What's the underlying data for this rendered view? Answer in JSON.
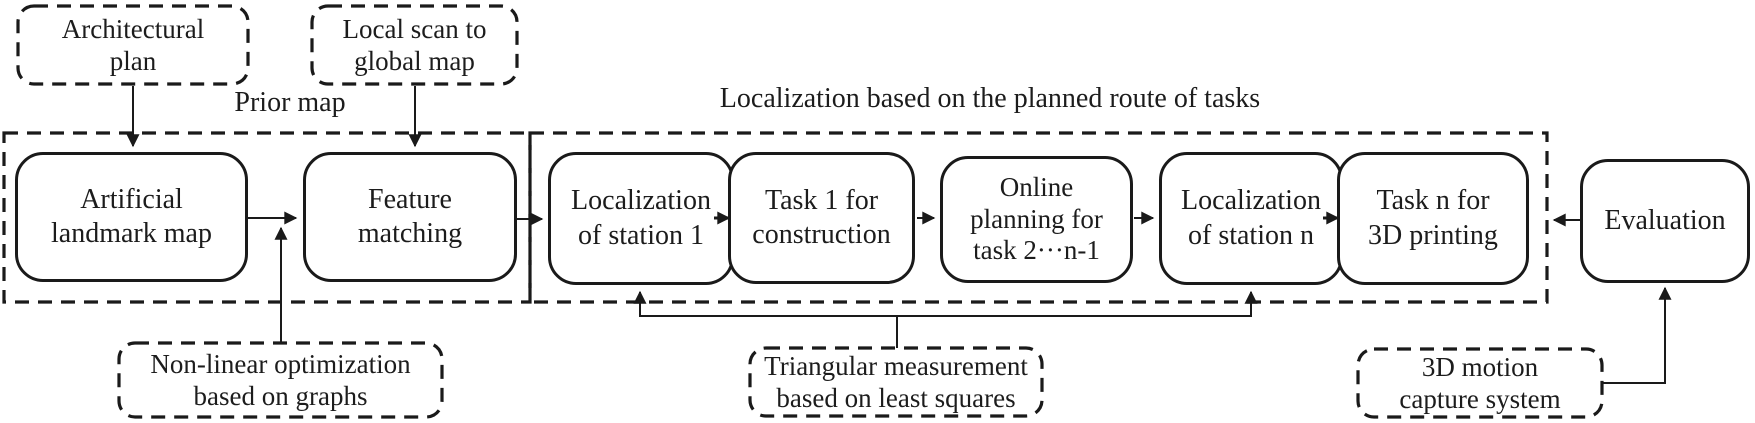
{
  "diagram": {
    "labels": {
      "prior_map": "Prior map",
      "localization_route": "Localization based on the planned route of tasks"
    },
    "nodes": {
      "architectural_plan": {
        "line1": "Architectural",
        "line2": "plan"
      },
      "local_scan": {
        "line1": "Local scan to",
        "line2": "global map"
      },
      "artificial_landmark": {
        "line1": "Artificial",
        "line2": "landmark map"
      },
      "feature_matching": {
        "line1": "Feature",
        "line2": "matching"
      },
      "loc_station_1": {
        "line1": "Localization",
        "line2": "of station 1"
      },
      "task_1": {
        "line1": "Task 1 for",
        "line2": "construction"
      },
      "online_planning": {
        "line1": "Online",
        "line2": "planning for",
        "line3": "task 2···n-1"
      },
      "loc_station_n": {
        "line1": "Localization",
        "line2": "of station n"
      },
      "task_n": {
        "line1": "Task n for",
        "line2": "3D printing"
      },
      "evaluation": {
        "line1": "Evaluation"
      },
      "nonlinear_optimization": {
        "line1": "Non-linear optimization",
        "line2": "based on graphs"
      },
      "triangular_measurement": {
        "line1": "Triangular measurement",
        "line2": "based on least squares"
      },
      "motion_capture": {
        "line1": "3D motion",
        "line2": "capture system"
      }
    },
    "colors": {
      "line": "#1a1a1a",
      "text": "#1c1c1c",
      "background": "#ffffff"
    }
  }
}
